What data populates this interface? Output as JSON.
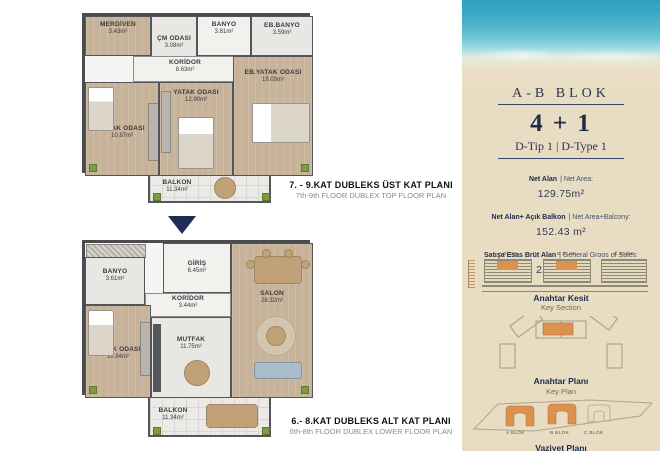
{
  "plans": {
    "top": {
      "caption_title": "7. - 9.KAT DUBLEKS ÜST KAT PLANI",
      "caption_subtitle": "7th-9th FLOOR DUBLEX TOP FLOOR PLAN",
      "rooms": [
        {
          "name": "MERDİVEN",
          "area": "3.43m²"
        },
        {
          "name": "ÇM ODASI",
          "area": "3.08m²"
        },
        {
          "name": "BANYO",
          "area": "3.81m²"
        },
        {
          "name": "EB.BANYO",
          "area": "3.59m²"
        },
        {
          "name": "KORİDOR",
          "area": "8.63m²"
        },
        {
          "name": "YATAK ODASI",
          "area": "12.90m²"
        },
        {
          "name": "EB.YATAK ODASI",
          "area": "19.03m²"
        },
        {
          "name": "YATAK ODASI",
          "area": "10.87m²"
        },
        {
          "name": "BALKON",
          "area": "11.34m²"
        }
      ]
    },
    "bottom": {
      "caption_title": "6.- 8.KAT DUBLEKS ALT KAT PLANI",
      "caption_subtitle": "6th-8th FLOOR DUBLEX LOWER FLOOR PLAN",
      "rooms": [
        {
          "name": "BANYO",
          "area": "3.61m²"
        },
        {
          "name": "GİRİŞ",
          "area": "6.45m²"
        },
        {
          "name": "KORİDOR",
          "area": "3.44m²"
        },
        {
          "name": "SALON",
          "area": "28.32m²"
        },
        {
          "name": "MUTFAK",
          "area": "11.75m²"
        },
        {
          "name": "YATAK ODASI",
          "area": "10.84m²"
        },
        {
          "name": "BALKON",
          "area": "11.34m²"
        }
      ]
    }
  },
  "sidebar": {
    "block_title": "A-B BLOK",
    "unit_type": "4 + 1",
    "type_label": "D-Tip 1  |  D-Type 1",
    "areas": [
      {
        "label_tr": "Net Alan",
        "label_en": "| Net Area:",
        "value": "129.75m²"
      },
      {
        "label_tr": "Net Alan+ Açık Balkon",
        "label_en": "| Net Area+Balcony:",
        "value": "152.43 m²"
      },
      {
        "label_tr": "Satışa Esas Brüt Alan",
        "label_en": "| General Groos of Sales:",
        "value": "221.02 m²"
      }
    ],
    "key_section": {
      "title_tr": "Anahtar Kesit",
      "title_en": "Key Section",
      "blocks": [
        "A BLOK",
        "B BLOK",
        "C BLOK"
      ]
    },
    "key_plan": {
      "title_tr": "Anahtar Planı",
      "title_en": "Key Plan"
    },
    "site_plan": {
      "title_tr": "Vaziyet Planı",
      "blocks": [
        "A BLOK",
        "B BLOK",
        "C BLOK"
      ]
    }
  },
  "colors": {
    "accent_orange": "#dd9150",
    "navy": "#223050",
    "wall_gray": "#4b4c50",
    "floor_tan": "#c7b29a",
    "sand": "#e8ddc3",
    "sea": "#3aa6c2"
  }
}
